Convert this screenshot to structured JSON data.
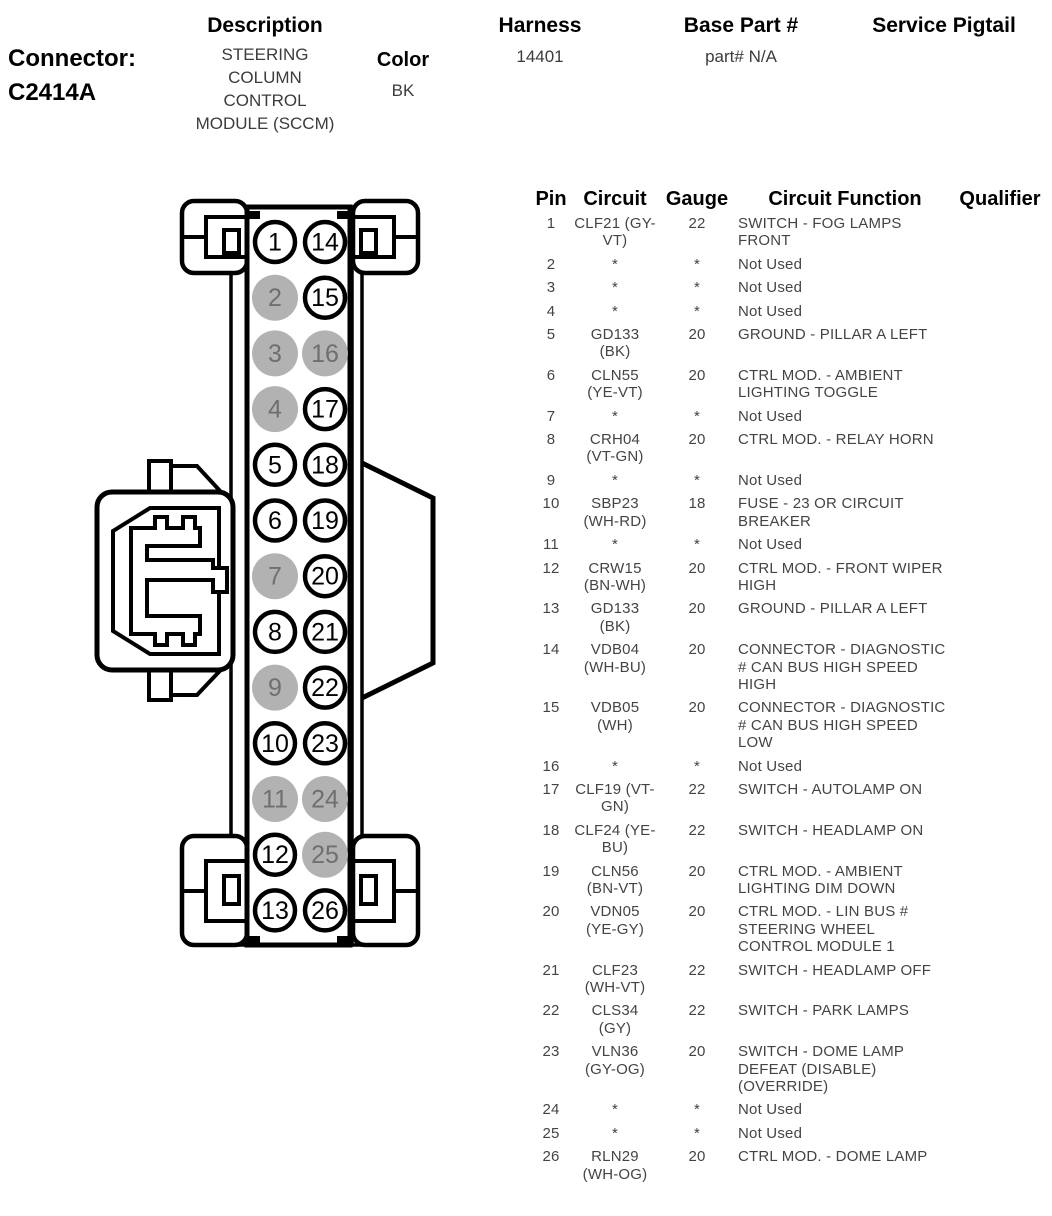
{
  "header": {
    "connector_label": "Connector:",
    "connector_id": "C2414A",
    "description_label": "Description",
    "description_value": "STEERING COLUMN CONTROL MODULE (SCCM)",
    "color_label": "Color",
    "color_value": "BK",
    "harness_label": "Harness",
    "harness_value": "14401",
    "base_part_label": "Base Part #",
    "base_part_value": "part# N/A",
    "service_pigtail_label": "Service Pigtail"
  },
  "connector_diagram": {
    "left_column_pins": [
      1,
      2,
      3,
      4,
      5,
      6,
      7,
      8,
      9,
      10,
      11,
      12,
      13
    ],
    "right_column_pins": [
      14,
      15,
      16,
      17,
      18,
      19,
      20,
      21,
      22,
      23,
      24,
      25,
      26
    ],
    "unused_pins": [
      2,
      3,
      4,
      7,
      9,
      11,
      16,
      24,
      25
    ],
    "pin_fill_used": "#ffffff",
    "pin_fill_unused": "#b2b2b2",
    "pin_text_used": "#000000",
    "pin_text_unused": "#6f6f6f",
    "outline_color": "#000000"
  },
  "pin_table": {
    "columns": [
      "Pin",
      "Circuit",
      "Gauge",
      "Circuit Function",
      "Qualifier"
    ],
    "rows": [
      {
        "pin": "1",
        "circuit": "CLF21 (GY-VT)",
        "gauge": "22",
        "function": "SWITCH - FOG LAMPS FRONT",
        "qualifier": ""
      },
      {
        "pin": "2",
        "circuit": "*",
        "gauge": "*",
        "function": "Not Used",
        "qualifier": ""
      },
      {
        "pin": "3",
        "circuit": "*",
        "gauge": "*",
        "function": "Not Used",
        "qualifier": ""
      },
      {
        "pin": "4",
        "circuit": "*",
        "gauge": "*",
        "function": "Not Used",
        "qualifier": ""
      },
      {
        "pin": "5",
        "circuit": "GD133 (BK)",
        "gauge": "20",
        "function": "GROUND - PILLAR A LEFT",
        "qualifier": ""
      },
      {
        "pin": "6",
        "circuit": "CLN55 (YE-VT)",
        "gauge": "20",
        "function": "CTRL MOD. - AMBIENT LIGHTING TOGGLE",
        "qualifier": ""
      },
      {
        "pin": "7",
        "circuit": "*",
        "gauge": "*",
        "function": "Not Used",
        "qualifier": ""
      },
      {
        "pin": "8",
        "circuit": "CRH04 (VT-GN)",
        "gauge": "20",
        "function": "CTRL MOD. - RELAY HORN",
        "qualifier": ""
      },
      {
        "pin": "9",
        "circuit": "*",
        "gauge": "*",
        "function": "Not Used",
        "qualifier": ""
      },
      {
        "pin": "10",
        "circuit": "SBP23 (WH-RD)",
        "gauge": "18",
        "function": "FUSE - 23 OR CIRCUIT BREAKER",
        "qualifier": ""
      },
      {
        "pin": "11",
        "circuit": "*",
        "gauge": "*",
        "function": "Not Used",
        "qualifier": ""
      },
      {
        "pin": "12",
        "circuit": "CRW15 (BN-WH)",
        "gauge": "20",
        "function": "CTRL MOD. - FRONT WIPER HIGH",
        "qualifier": ""
      },
      {
        "pin": "13",
        "circuit": "GD133 (BK)",
        "gauge": "20",
        "function": "GROUND - PILLAR A LEFT",
        "qualifier": ""
      },
      {
        "pin": "14",
        "circuit": "VDB04 (WH-BU)",
        "gauge": "20",
        "function": "CONNECTOR - DIAGNOSTIC # CAN BUS HIGH SPEED HIGH",
        "qualifier": ""
      },
      {
        "pin": "15",
        "circuit": "VDB05 (WH)",
        "gauge": "20",
        "function": "CONNECTOR - DIAGNOSTIC # CAN BUS HIGH SPEED LOW",
        "qualifier": ""
      },
      {
        "pin": "16",
        "circuit": "*",
        "gauge": "*",
        "function": "Not Used",
        "qualifier": ""
      },
      {
        "pin": "17",
        "circuit": "CLF19 (VT-GN)",
        "gauge": "22",
        "function": "SWITCH - AUTOLAMP ON",
        "qualifier": ""
      },
      {
        "pin": "18",
        "circuit": "CLF24 (YE-BU)",
        "gauge": "22",
        "function": "SWITCH - HEADLAMP ON",
        "qualifier": ""
      },
      {
        "pin": "19",
        "circuit": "CLN56 (BN-VT)",
        "gauge": "20",
        "function": "CTRL MOD. - AMBIENT LIGHTING DIM DOWN",
        "qualifier": ""
      },
      {
        "pin": "20",
        "circuit": "VDN05 (YE-GY)",
        "gauge": "20",
        "function": "CTRL MOD. - LIN BUS # STEERING WHEEL CONTROL MODULE 1",
        "qualifier": ""
      },
      {
        "pin": "21",
        "circuit": "CLF23 (WH-VT)",
        "gauge": "22",
        "function": "SWITCH - HEADLAMP OFF",
        "qualifier": ""
      },
      {
        "pin": "22",
        "circuit": "CLS34 (GY)",
        "gauge": "22",
        "function": "SWITCH - PARK LAMPS",
        "qualifier": ""
      },
      {
        "pin": "23",
        "circuit": "VLN36 (GY-OG)",
        "gauge": "20",
        "function": "SWITCH - DOME LAMP DEFEAT (DISABLE) (OVERRIDE)",
        "qualifier": ""
      },
      {
        "pin": "24",
        "circuit": "*",
        "gauge": "*",
        "function": "Not Used",
        "qualifier": ""
      },
      {
        "pin": "25",
        "circuit": "*",
        "gauge": "*",
        "function": "Not Used",
        "qualifier": ""
      },
      {
        "pin": "26",
        "circuit": "RLN29 (WH-OG)",
        "gauge": "20",
        "function": "CTRL MOD. - DOME LAMP",
        "qualifier": ""
      }
    ]
  }
}
